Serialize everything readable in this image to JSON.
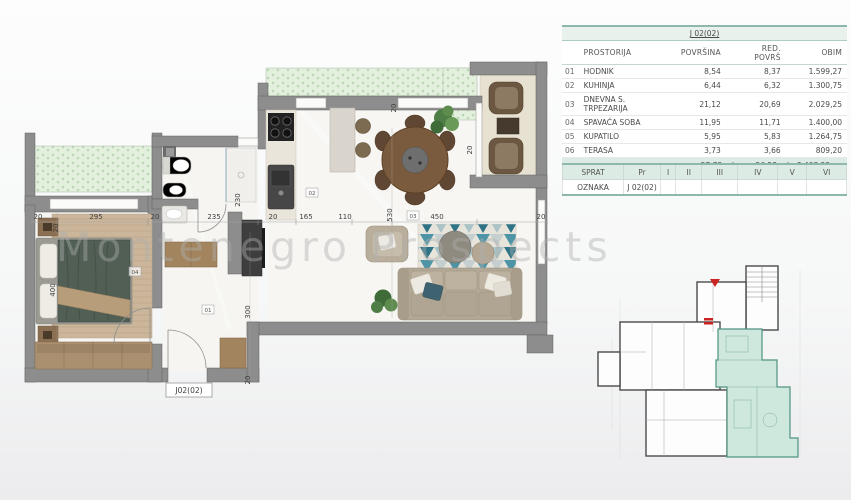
{
  "watermark": "Montenegro Prospects",
  "area_table": {
    "title": "J 02(02)",
    "columns": {
      "room": "PROSTORIJA",
      "area": "POVRŠINA",
      "red_area": "RED. POVRŠ",
      "perimeter": "OBIM"
    },
    "rows": [
      {
        "num": "01",
        "room": "HODNIK",
        "area": "8,54",
        "red_area": "8,37",
        "perimeter": "1.599,27"
      },
      {
        "num": "02",
        "room": "KUHINJA",
        "area": "6,44",
        "red_area": "6,32",
        "perimeter": "1.300,75"
      },
      {
        "num": "03",
        "room": "DNEVNA S. TRPEZARIJA",
        "area": "21,12",
        "red_area": "20,69",
        "perimeter": "2.029,25"
      },
      {
        "num": "04",
        "room": "SPAVAĆA SOBA",
        "area": "11,95",
        "red_area": "11,71",
        "perimeter": "1.400,00"
      },
      {
        "num": "05",
        "room": "KUPATILO",
        "area": "5,95",
        "red_area": "5,83",
        "perimeter": "1.264,75"
      },
      {
        "num": "06",
        "room": "TERASA",
        "area": "3,73",
        "red_area": "3,66",
        "perimeter": "809,20"
      }
    ],
    "totals": {
      "area": "57,73 m²",
      "red_area": "56,58 m²",
      "perimeter": "8.403,22 cm"
    }
  },
  "floor_table": {
    "headers": [
      "SPRAT",
      "Pr",
      "I",
      "II",
      "III",
      "IV",
      "V",
      "VI"
    ],
    "row_label": "OZNAKA",
    "row_values": [
      "J 02(02)",
      "",
      "",
      "",
      "",
      "",
      ""
    ]
  },
  "floorplan": {
    "unit_label": "J02(02)",
    "h_dims": [
      "20",
      "295",
      "20",
      "235",
      "20",
      "165",
      "110",
      "450",
      "20"
    ],
    "v_dims": [
      "20",
      "400",
      "230",
      "530",
      "20",
      "300",
      "20",
      "10",
      "20"
    ],
    "room_markers": [
      "01",
      "02",
      "03",
      "04"
    ]
  },
  "colors": {
    "accent_teal": "#8fb8ac",
    "band_teal": "#dcebe3",
    "wall_gray": "#8d8d8d",
    "greenery": "#e4f0de",
    "unit_highlight": "#cfe8dd",
    "red_marker": "#cc2222"
  }
}
